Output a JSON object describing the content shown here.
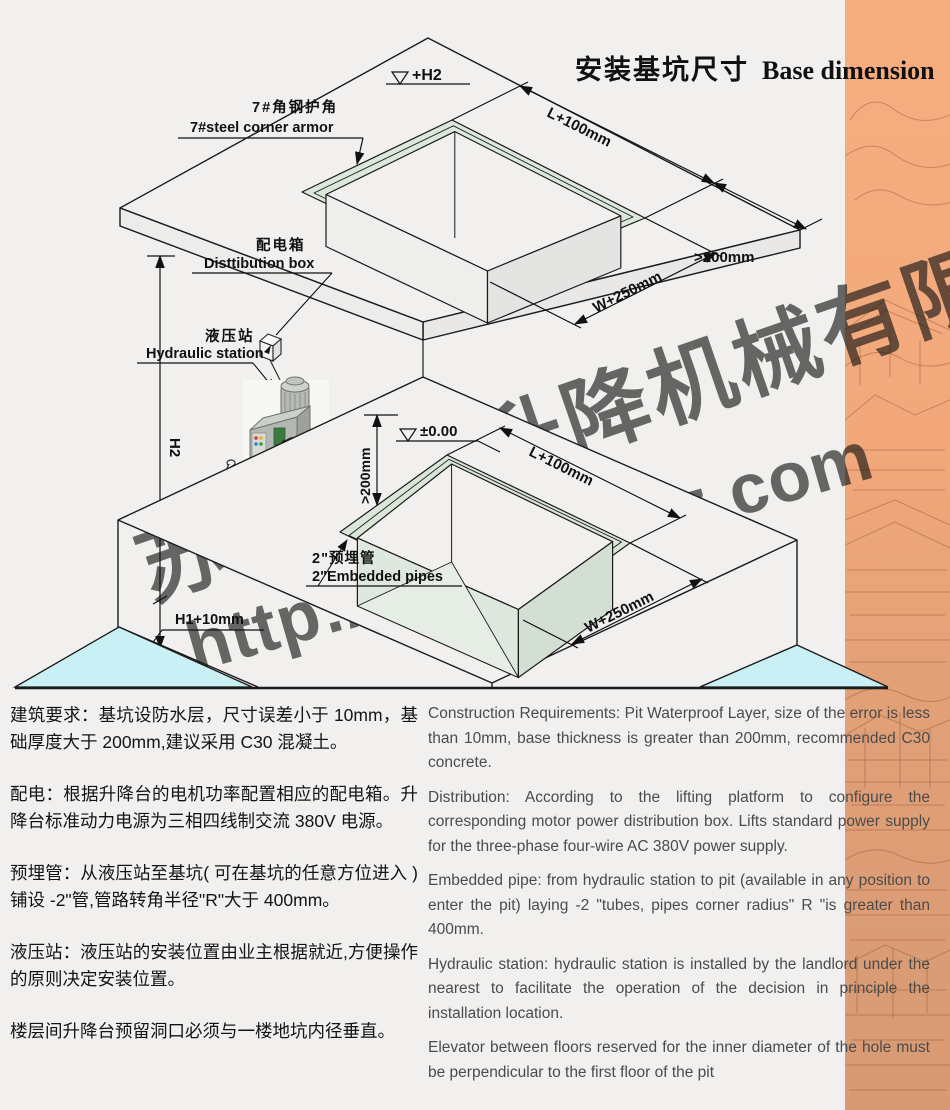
{
  "title": {
    "zh": "安装基坑尺寸",
    "en": "Base dimension"
  },
  "watermark": {
    "company": "苏州卓禹升降机械有限公司",
    "url": "http://www.sjjsz.com"
  },
  "diagram": {
    "level_top": "+H2",
    "level_zero": "±0.00",
    "dim_top_length": "L+100mm",
    "dim_top_margin": ">200mm",
    "dim_top_width": "W+250mm",
    "dim_pit_length": "L+100mm",
    "dim_pit_width": "W+250mm",
    "dim_pit_clearance": ">200mm",
    "dim_wall_height": "H2",
    "dim_pit_depth": "H1+10mm",
    "label_corner_armor_zh": "7#角钢护角",
    "label_corner_armor_en": "7#steel corner armor",
    "label_distribution_zh": "配电箱",
    "label_distribution_en": "Disttibution box",
    "label_hydraulic_zh": "液压站",
    "label_hydraulic_en": "Hydraulic station",
    "label_pipes_zh": "2\"预埋管",
    "label_pipes_en": "2\"Embedded pipes",
    "label_radius": "R"
  },
  "notes_zh": [
    "建筑要求：基坑设防水层，尺寸误差小于 10mm，基础厚度大于 200mm,建议采用 C30 混凝土。",
    "配电：根据升降台的电机功率配置相应的配电箱。升降台标准动力电源为三相四线制交流 380V 电源。",
    "预埋管：从液压站至基坑( 可在基坑的任意方位进入 )铺设 -2\"管,管路转角半径\"R\"大于 400mm。",
    "液压站：液压站的安装位置由业主根据就近,方便操作的原则决定安装位置。",
    "楼层间升降台预留洞口必须与一楼地坑内径垂直。"
  ],
  "notes_en": [
    "Construction Requirements: Pit Waterproof Layer, size of the error is less than 10mm, base thickness is greater than 200mm, recommended C30 concrete.",
    "Distribution: According to the lifting platform to configure the corresponding motor power distribution box. Lifts standard power supply for the three-phase four-wire AC 380V power supply.",
    "Embedded pipe: from hydraulic station to pit (available in any position to enter the pit) laying -2 \"tubes, pipes corner radius\" R \"is greater than 400mm.",
    "Hydraulic station: hydraulic station is installed by the landlord under the nearest to facilitate the operation of the decision in principle the installation location.",
    "Elevator between floors reserved for the inner diameter of the hole must be perpendicular to the first floor of the pit"
  ],
  "colors": {
    "accent_band": "#f2a87a",
    "armor_green": "#dce8dc",
    "cut_cyan": "#c9f0f5"
  }
}
